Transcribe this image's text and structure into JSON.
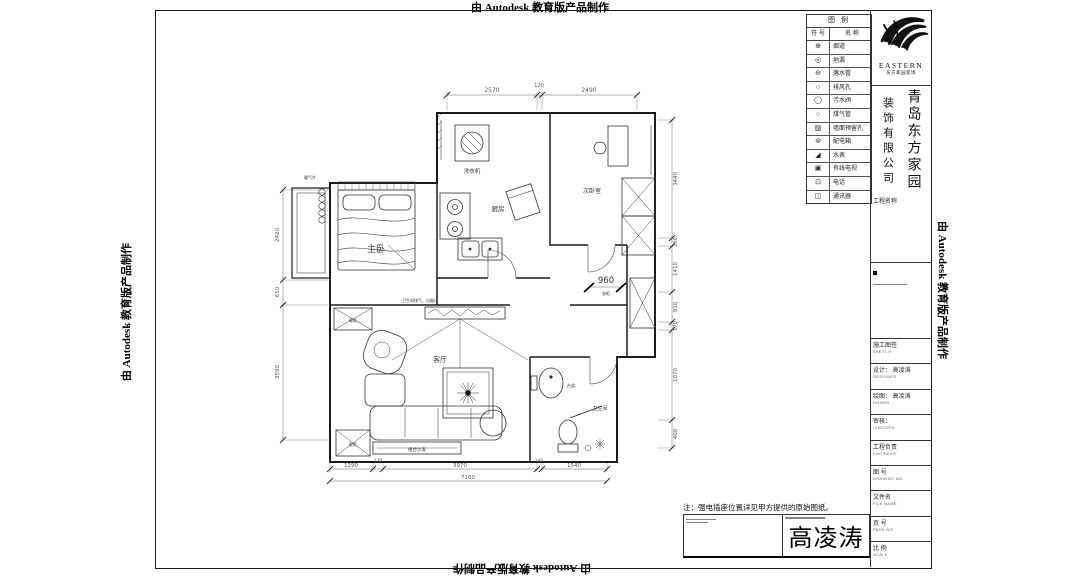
{
  "watermark": {
    "text": "由 Autodesk 教育版产品制作"
  },
  "legend": {
    "title": "图  例",
    "col_symbol": "符 号",
    "col_name": "名 称",
    "rows": [
      {
        "symbol": "⊕",
        "name": "烟道"
      },
      {
        "symbol": "◎",
        "name": "地漏"
      },
      {
        "symbol": "⊖",
        "name": "落水管"
      },
      {
        "symbol": "○",
        "name": "排风孔"
      },
      {
        "symbol": "◯",
        "name": "污水阀"
      },
      {
        "symbol": "○",
        "name": "煤气管"
      },
      {
        "symbol": "▨",
        "name": "墙面预留孔"
      },
      {
        "symbol": "⊜",
        "name": "配电箱"
      },
      {
        "symbol": "◢",
        "name": "水表"
      },
      {
        "symbol": "▣",
        "name": "有线电视"
      },
      {
        "symbol": "⊡",
        "name": "电话"
      },
      {
        "symbol": "◫",
        "name": "通讯器"
      }
    ]
  },
  "brand": {
    "logo_text": "EASTERN",
    "logo_sub": "东方家园装饰",
    "company_right": "青岛东方家园",
    "company_left": "装饰有限公司"
  },
  "titleblock": {
    "project_label": "工程名称",
    "rows": [
      {
        "label": "施工图签",
        "sub": "SKETCH"
      },
      {
        "label": "设计： 高凌涛",
        "sub": "DESIGNER"
      },
      {
        "label": "绘图： 高凌涛",
        "sub": "DRAWN"
      },
      {
        "label": "审核：",
        "sub": "CHECKED"
      },
      {
        "label": "工程负责",
        "sub": "ENGINEER"
      },
      {
        "label": "图  号",
        "sub": "DRAWING  NO."
      },
      {
        "label": "文件名",
        "sub": "FILE NAME"
      },
      {
        "label": "页  号",
        "sub": "PAGE NO."
      },
      {
        "label": "比  例",
        "sub": "SCALE"
      }
    ]
  },
  "note": {
    "text": "注：强电插座位置详见甲方提供的原始图纸。"
  },
  "signature": {
    "name": "高凌涛"
  },
  "plan": {
    "rooms": {
      "master": "主卧",
      "kitchen": "厨房",
      "bedroom2": "次卧室",
      "living": "客厅",
      "bath": "卫生间"
    },
    "labels": {
      "washer": "洗衣机",
      "shoe_top": "鞋柜",
      "shoe_bottom": "鞋柜",
      "wardrobe": "衣柜",
      "sofa": "组合沙发",
      "basin": "台盆",
      "vent": "卫生间排气、出烟口",
      "radiator": "暖气片"
    },
    "dims": {
      "top": [
        "2570",
        "120",
        "2490"
      ],
      "right": [
        "3440",
        "200",
        "1410",
        "910",
        "170",
        "1070",
        "400"
      ],
      "left": [
        "2420",
        "650",
        "3590"
      ],
      "bottom": [
        "1290",
        "120",
        "3970",
        "140",
        "1540"
      ],
      "total": "7160",
      "storage": "960"
    }
  }
}
